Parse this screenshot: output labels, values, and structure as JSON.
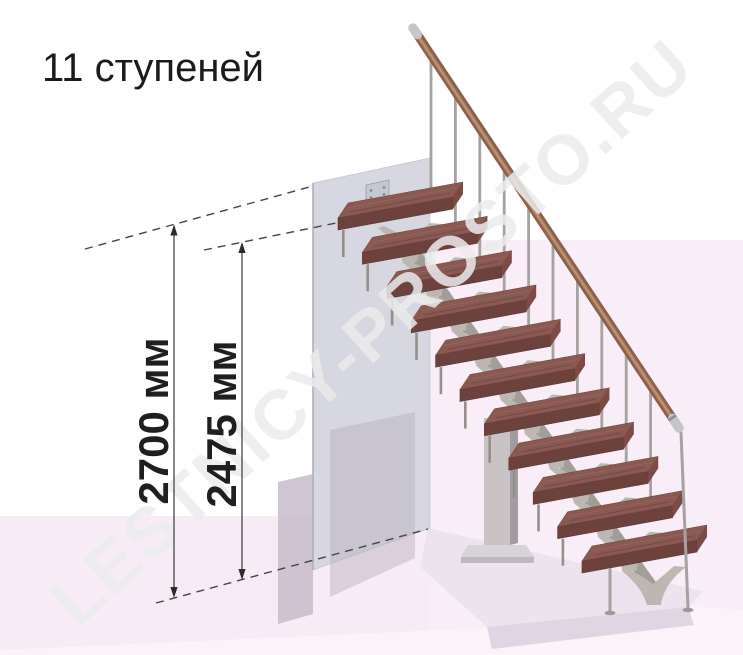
{
  "title": "11 ступеней",
  "watermark": {
    "text": "LESTNICY-PROSTO.RU"
  },
  "stairs": {
    "steps_count": 11
  },
  "dimensions": {
    "overall_height": {
      "value": 2700,
      "unit": "мм",
      "label": "2700 мм"
    },
    "to_top_step": {
      "value": 2475,
      "unit": "мм",
      "label": "2475 мм"
    }
  },
  "colors": {
    "tread_top": "#8a5952",
    "tread_front": "#6d423d",
    "tread_end": "#7d4b44",
    "tread_grain_dark": "#69403a",
    "tread_grain_light": "#9c6f64",
    "metal_stringer": "#a19d97",
    "bracket": "#bcb8b1",
    "baluster": "#a5a2a0",
    "rod": "#93908b",
    "rail": "#8d5f49",
    "rail_highlight": "#c69c7e",
    "rail_cap": "#c6c6c8",
    "wall": "#d6d7e0",
    "wall_top": "#eceef3",
    "plate": "#c5c8d0",
    "column": "#c9c3c6",
    "floor_left": "#f7ecf5",
    "floor_right": "#f9edf8",
    "platform": "#ebe3ed",
    "platform_front": "#ded6e2",
    "shadow_band": "#cbbfcd",
    "annotation": "#2e2b2e"
  }
}
